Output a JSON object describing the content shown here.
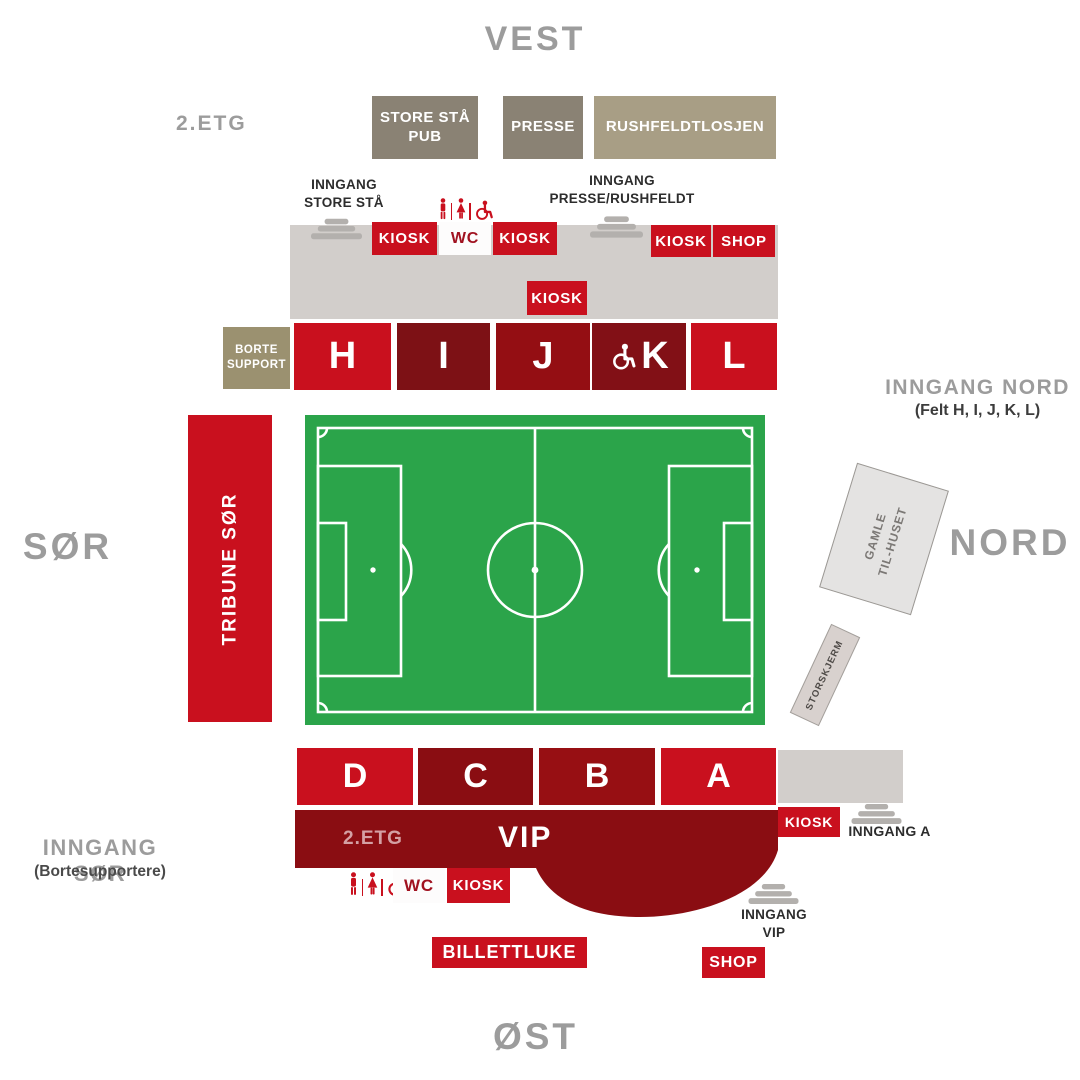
{
  "compass": {
    "west": "VEST",
    "south": "SØR",
    "north": "NORD",
    "east": "ØST"
  },
  "strings": {
    "kiosk": "KIOSK",
    "wc": "WC",
    "shop": "SHOP"
  },
  "west_stand": {
    "floor_label": "2.ETG",
    "lounges": [
      {
        "id": "store-staa-pub",
        "label": "STORE STÅ\nPUB"
      },
      {
        "id": "presse",
        "label": "PRESSE"
      },
      {
        "id": "rushfeldtlosjen",
        "label": "RUSHFELDTLOSJEN"
      }
    ],
    "entrance_store_staa": "INNGANG\nSTORE STÅ",
    "entrance_presse": "INNGANG\nPRESSE/RUSHFELDT",
    "away_section": "BORTE\nSUPPORT",
    "sections": [
      "H",
      "I",
      "J",
      "K",
      "L"
    ]
  },
  "south_stand": {
    "label": "TRIBUNE SØR",
    "entrance": "INNGANG SØR",
    "entrance_note": "(Bortesupportere)"
  },
  "north_side": {
    "entrance": "INNGANG NORD",
    "entrance_note": "(Felt H, I, J, K, L)",
    "old_clubhouse": "GAMLE\nTIL-HUSET",
    "big_screen": "STORSKJERM"
  },
  "east_stand": {
    "sections": [
      "D",
      "C",
      "B",
      "A"
    ],
    "floor_label": "2.ETG",
    "vip_label": "VIP",
    "entrance_a": "INNGANG A",
    "entrance_vip": "INNGANG\nVIP",
    "ticket_office": "BILLETTLUKE"
  },
  "colors": {
    "bright_red": "#c9101e",
    "dark_red": "#8a0d12",
    "section_i": "#7d1115",
    "section_j": "#940e13",
    "section_k": "#821016",
    "section_b": "#970f13",
    "olive": "#8a8274",
    "tan": "#a89e85",
    "away_olive": "#9b9170",
    "concourse_gray": "#d2cecb",
    "stairs_gray": "#b3b0ad",
    "field_green": "#2ba44a",
    "label_gray": "#9c9c9c",
    "dark_text": "#2d2d2d"
  }
}
